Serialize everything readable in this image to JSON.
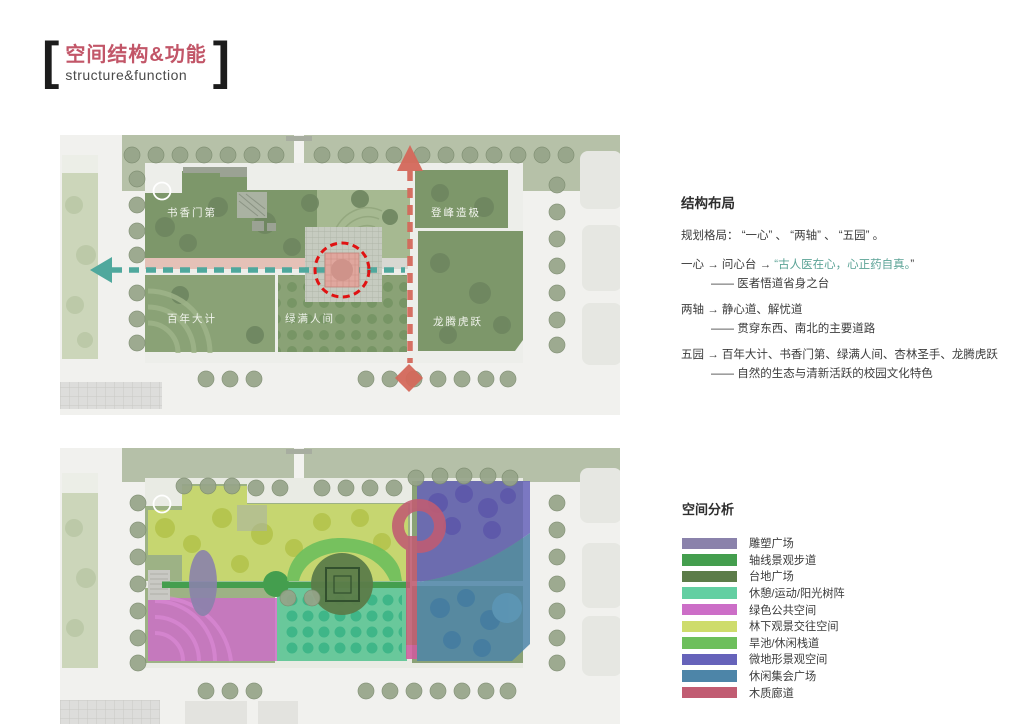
{
  "title": {
    "bracket_left": "[",
    "bracket_right": "]",
    "zh": "空间结构&功能",
    "en": "structure&function",
    "accent_color": "#c25668"
  },
  "structure_section": {
    "heading": "结构布局",
    "intro": "规划格局： “一心” 、 “两轴” 、 “五园” 。",
    "highlight_color": "#5ba396",
    "items": [
      {
        "main": "一心 → 问心台 → ",
        "highlight": "“古人医在心，心正药自真。",
        "tail": "”",
        "sub": "—— 医者悟道省身之台"
      },
      {
        "main": "两轴 → 静心道、解忧道",
        "highlight": "",
        "tail": "",
        "sub": "—— 贯穿东西、南北的主要道路"
      },
      {
        "main": "五园 → 百年大计、书香门第、绿满人间、杏林圣手、龙腾虎跃",
        "highlight": "",
        "tail": "",
        "sub": "—— 自然的生态与清新活跃的校园文化特色"
      }
    ]
  },
  "plan_structure": {
    "labels": {
      "park1": "书香门第",
      "park2": "登峰造极",
      "park3": "百年大计",
      "park4": "绿满人间",
      "park5": "龙腾虎跃"
    },
    "axes": {
      "east_west_color": "#4fa89d",
      "north_south_color": "#d4695b",
      "core_ring_color": "#e01212"
    }
  },
  "analysis_section": {
    "heading": "空间分析",
    "items": [
      {
        "label": "雕塑广场",
        "color": "#8a82ab"
      },
      {
        "label": "轴线景观步道",
        "color": "#449e4e"
      },
      {
        "label": "台地广场",
        "color": "#5c7c49"
      },
      {
        "label": "休憩/运动/阳光树阵",
        "color": "#63cfa2"
      },
      {
        "label": "绿色公共空间",
        "color": "#cc6ec7"
      },
      {
        "label": "林下观景交往空间",
        "color": "#cedc6c"
      },
      {
        "label": "旱池/休闲栈道",
        "color": "#6dbf5c"
      },
      {
        "label": "微地形景观空间",
        "color": "#6663ba"
      },
      {
        "label": "休闲集会广场",
        "color": "#4d85a8"
      },
      {
        "label": "木质廊道",
        "color": "#c15c72"
      }
    ]
  }
}
